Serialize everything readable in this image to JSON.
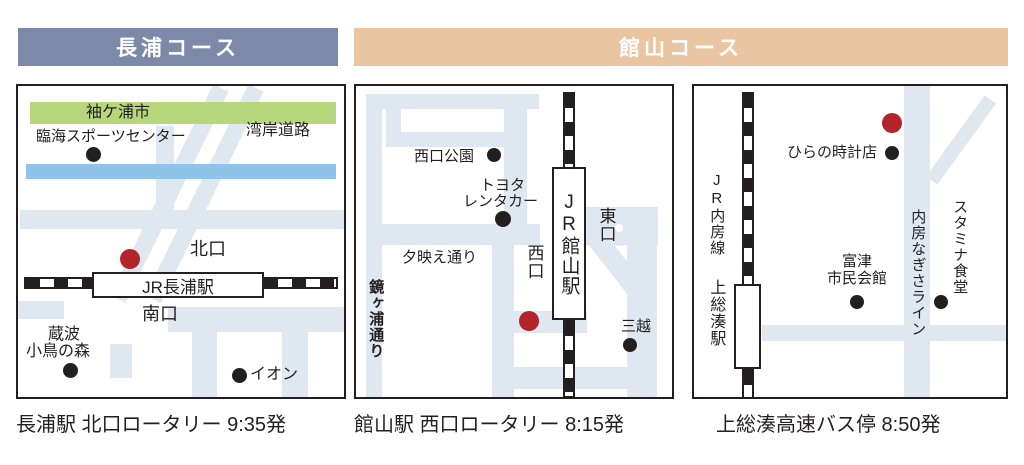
{
  "header": {
    "nagaura_title": "長浦コース",
    "tateyama_title": "館山コース"
  },
  "nagaura_map": {
    "sodegaura_city": "袖ケ浦市",
    "rinkai_sports_center": "臨海スポーツセンター",
    "wangan_road": "湾岸道路",
    "north_exit": "北口",
    "station_name": "JR長浦駅",
    "south_exit": "南口",
    "kuranami_line1": "蔵波",
    "kuranami_line2": "小鳥の森",
    "aeon": "イオン",
    "caption": "長浦駅 北口ロータリー 9:35発"
  },
  "tateyama_map": {
    "nishiguchi_park": "西口公園",
    "toyota_line1": "トヨタ",
    "toyota_line2": "レンタカー",
    "yubae_street": "夕映え通り",
    "kagamigaura_street": "鏡ヶ浦通り",
    "west_exit": "西口",
    "east_exit": "東口",
    "station_name": "JR館山駅",
    "mitsukoshi": "三越",
    "caption": "館山駅 西口ロータリー 8:15発"
  },
  "kazusaminato_map": {
    "jr_uchibo_line": "JR内房線",
    "station_name": "上総湊駅",
    "hirano_clock_shop": "ひらの時計店",
    "futtsu_hall_line1": "富津",
    "futtsu_hall_line2": "市民会館",
    "uchibo_nagisa_line": "内房なぎさライン",
    "stamina_shokudo": "スタミナ食堂",
    "caption": "上総湊高速バス停 8:50発"
  },
  "colors": {
    "nagaura_header_bg": "#7d89a8",
    "tateyama_header_bg": "#eac5a2",
    "road": "#dfe8f0",
    "green_band": "#b7d77d",
    "blue_band": "#90c3e9",
    "meeting_point_red": "#b2242a",
    "ink": "#231f20"
  }
}
